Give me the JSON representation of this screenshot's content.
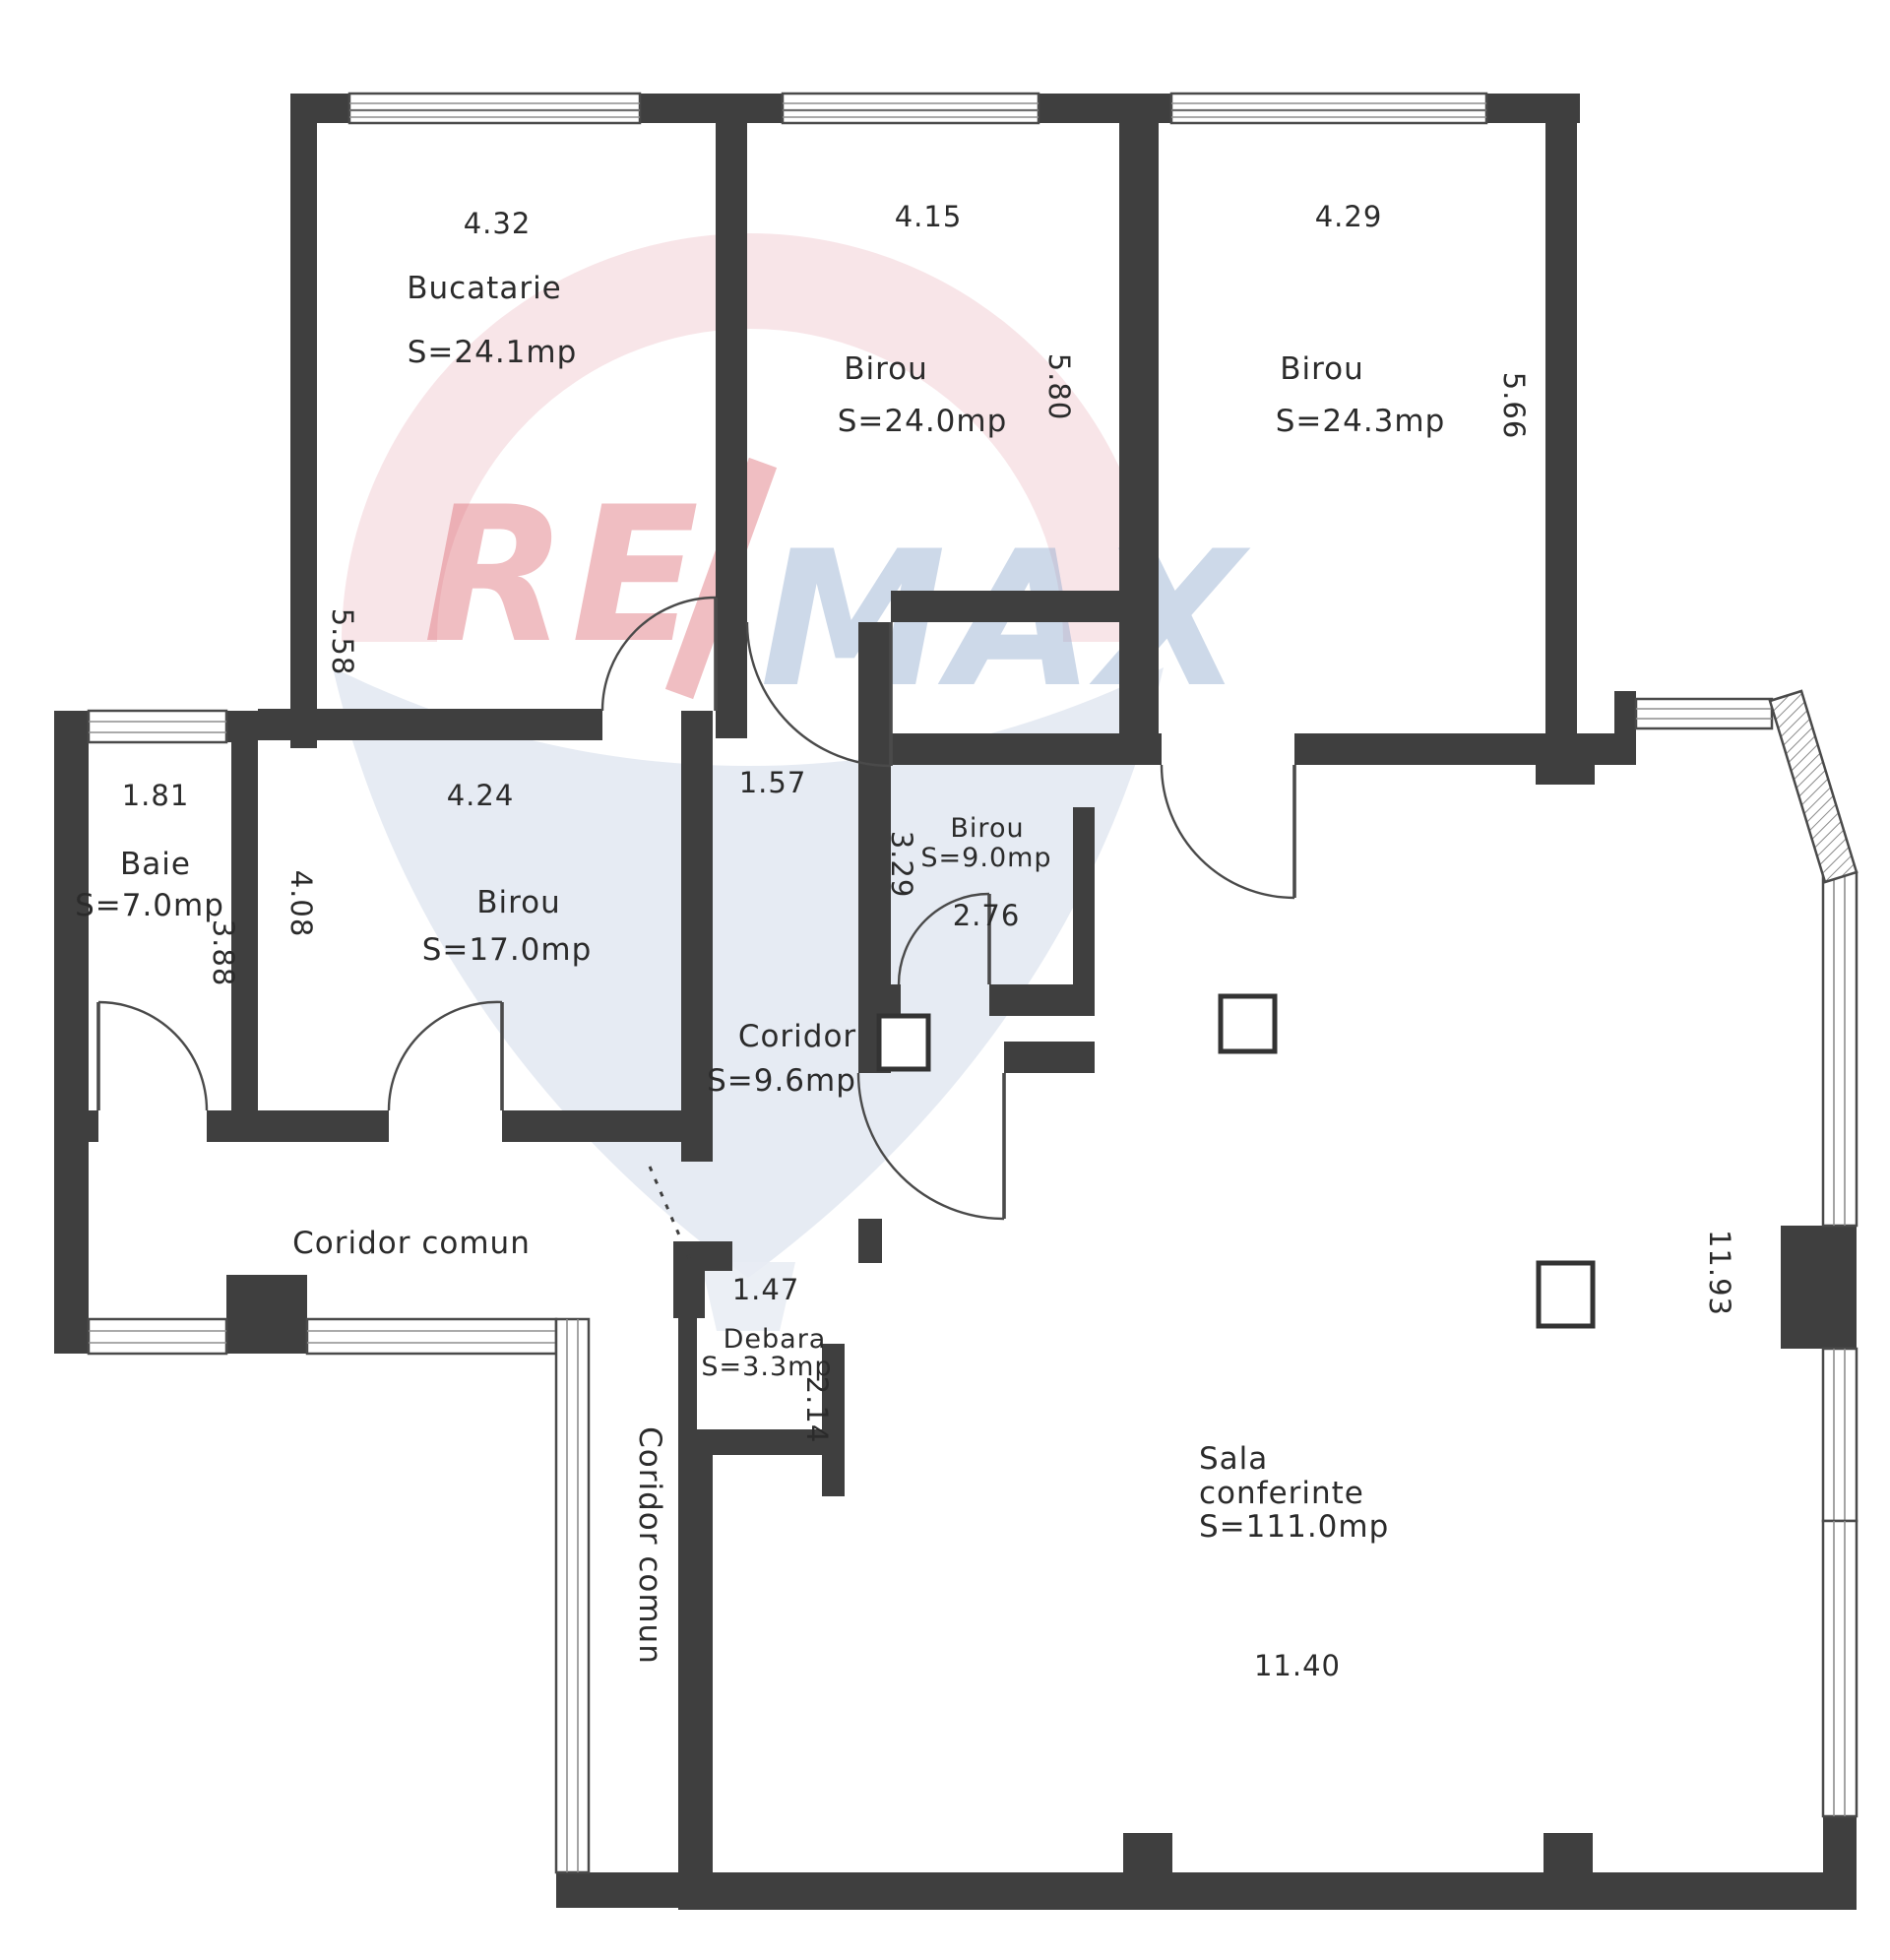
{
  "watermark": {
    "re": "RE",
    "slash": "/",
    "max": "MAX"
  },
  "colors": {
    "wall": "#3f3f3f",
    "plan_line": "#4a4a4a",
    "text": "#2b2b2b",
    "watermark_pink": "#f2cdd2",
    "watermark_red": "#dd6670",
    "watermark_blue": "#8aa6cc",
    "watermark_balloon": "#dfe6f0"
  },
  "rooms": {
    "bucatarie": {
      "name": "Bucatarie",
      "area": "S=24.1mp",
      "width": "4.32",
      "height": "5.58"
    },
    "birou_top_mid": {
      "name": "Birou",
      "area": "S=24.0mp",
      "width": "4.15",
      "height": "5.80"
    },
    "birou_top_right": {
      "name": "Birou",
      "area": "S=24.3mp",
      "width": "4.29",
      "height": "5.66"
    },
    "baie": {
      "name": "Baie",
      "area": "S=7.0mp",
      "width": "1.81",
      "height": "3.88"
    },
    "birou_mid": {
      "name": "Birou",
      "area": "S=17.0mp",
      "width": "4.24",
      "height": "4.08"
    },
    "coridor": {
      "name": "Coridor",
      "area": "S=9.6mp",
      "width": "1.57"
    },
    "birou_small": {
      "name": "Birou",
      "area": "S=9.0mp",
      "height": "3.29",
      "width_bottom": "2.76"
    },
    "coridor_comun_h": {
      "name": "Coridor comun"
    },
    "coridor_comun_v": {
      "name": "Coridor comun"
    },
    "debara": {
      "name": "Debara",
      "area": "S=3.3mp",
      "width": "1.47",
      "height": "2.14"
    },
    "sala": {
      "name_line1": "Sala",
      "name_line2": "conferinte",
      "area": "S=111.0mp",
      "width_bottom": "11.40",
      "height": "11.93"
    }
  }
}
